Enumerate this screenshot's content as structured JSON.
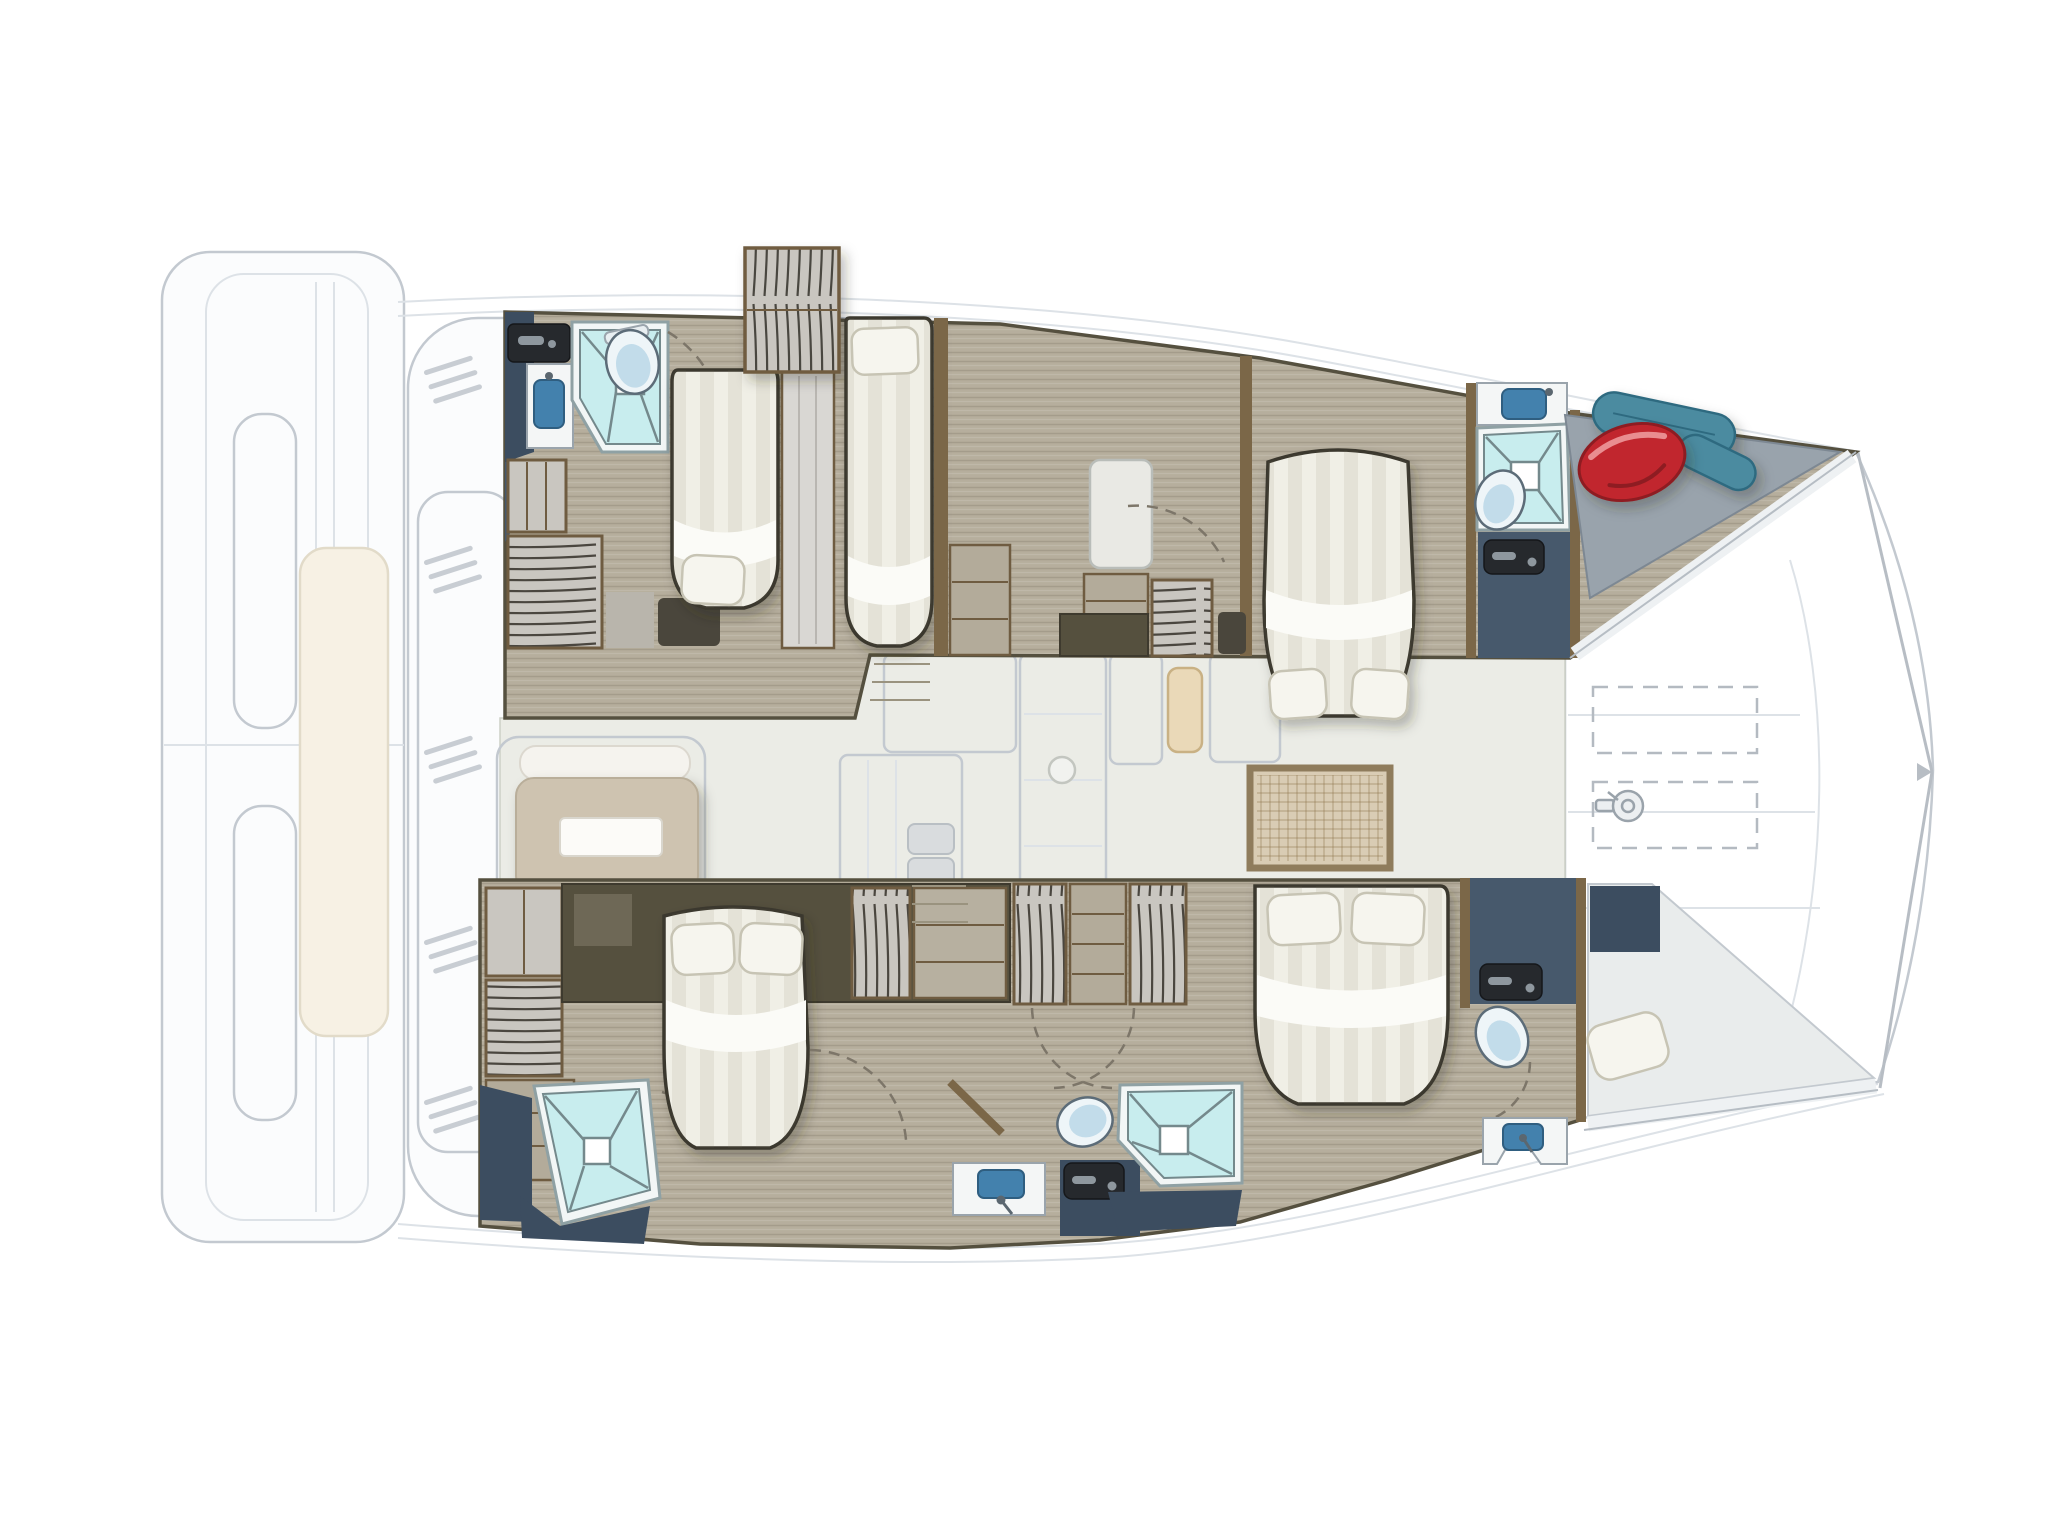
{
  "document": {
    "type": "catamaran-deck-plan",
    "view": "top-down-floor-plan",
    "background": "#ffffff"
  },
  "colors": {
    "ghost_stroke": "#c3c9d0",
    "ghost_stroke_light": "#dde2e7",
    "ghost_fill": "#fbfcfd",
    "ghost_fill2": "#f4f6f7",
    "ghost_beige": "#f7f1e4",
    "salon_floor": "#ebece6",
    "wood_floor": "#b6ae9d",
    "wood_wall": "#7b6748",
    "band_outline": "#55503f",
    "cabinet_frame": "#6f5c41",
    "cabinet_dark": "#55503e",
    "slat_base": "#c9c6c0",
    "shelf_base": "#b3ab9a",
    "navy": "#47596c",
    "navy_dark": "#3c4d60",
    "black_panel": "#26292d",
    "handle_gray": "#8e979e",
    "shower_frame": "#f2f6f6",
    "shower_fill": "#c8edee",
    "shower_line": "#74898c",
    "shower_stroke": "#8fa1a4",
    "toilet_fill": "#eef5f8",
    "toilet_blue": "#c2dcea",
    "toilet_stroke": "#5c6c78",
    "sink_blue": "#4381ad",
    "bed_fill": "#f0efe6",
    "bed_stroke": "#3a372e",
    "bed_white": "#fbfbf7",
    "pillow": "#f6f5ee",
    "pillow_stroke": "#c7c4b4",
    "sofa": "#cec3b0",
    "mat": "#d9ccb4",
    "mat_border": "#8f7c5c",
    "fender_red": "#c1272d",
    "fender_red_dark": "#8e1c22",
    "fender_teal": "#4c8ba0",
    "fender_teal_dark": "#2f6b80",
    "deck_gray": "#99a3ac",
    "deck_gray_dark": "#7d8893",
    "arc_color": "#7d7669",
    "rug_dark": "#4a463c",
    "step_line": "#9a937f"
  },
  "icons": [
    "shower-icon",
    "toilet-icon",
    "sink-icon",
    "double-bed-icon",
    "single-bed-icon",
    "pillow-icon",
    "wardrobe-icon",
    "hanging-locker-icon",
    "door-swing-icon",
    "fender-icon",
    "windlass-icon",
    "hatch-icon",
    "steps-icon"
  ],
  "rooms": {
    "port_hull": [
      "aft-bathroom",
      "aft-cabin-double-bed",
      "aft-cabin-single-bed",
      "midship-wardrobes",
      "forward-cabin-double-bed",
      "forward-bathroom",
      "bow-locker-with-fenders"
    ],
    "starboard_hull": [
      "aft-bathroom-shower",
      "aft-cabin-double-bed",
      "midship-wardrobes",
      "day-head-toilet-sink",
      "forward-cabin-double-bed",
      "forward-bathroom",
      "bow-berth"
    ],
    "main_deck": [
      "salon",
      "sofa-with-table",
      "galley-ghost",
      "woven-mat",
      "entry-door",
      "foredeck-panels",
      "anchor-hatches",
      "stern-platform",
      "cockpit-ghost"
    ]
  },
  "counts": {
    "double_beds": 4,
    "single_beds": 1,
    "bow_berths": 1,
    "showers": 4,
    "toilets": 4,
    "sinks": 4,
    "fenders": 3
  }
}
